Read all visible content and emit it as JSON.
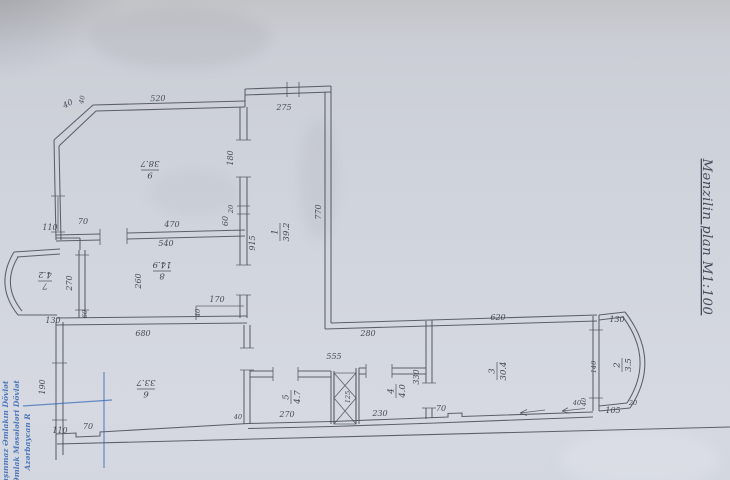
{
  "page": {
    "side_title": "Mənzilin plan M1:100",
    "stamp": {
      "color": "#3565b5",
      "lines": [
        "Daşınmaz Əmlakın Dövlət",
        "Əmlak Məsələləri Dövlət",
        "Azərbaycan R"
      ]
    }
  },
  "plan": {
    "rooms": [
      {
        "number": "1",
        "area": "39.2"
      },
      {
        "number": "2",
        "area": "3.5"
      },
      {
        "number": "3",
        "area": "30.4"
      },
      {
        "number": "4",
        "area": "4.0"
      },
      {
        "number": "5",
        "area": "4.7"
      },
      {
        "number": "6",
        "area": "33.7"
      },
      {
        "number": "7",
        "area": "4.2"
      },
      {
        "number": "8",
        "area": "14.9"
      },
      {
        "number": "9",
        "area": "38.7"
      }
    ],
    "dims": {
      "chamfer_40a": "40",
      "chamfer_40b": "40",
      "r9_top": "520",
      "corridor_top": "275",
      "corridor_right": "770",
      "corridor_len": "915",
      "door9_180": "180",
      "corridor_20": "20",
      "r9_110": "110",
      "r9_70": "70",
      "r9_bottom": "470",
      "junction_60": "60",
      "r8_top": "540",
      "r8_height": "260",
      "bow7_window": "270",
      "bow7_bottom": "130",
      "r8_step_170": "170",
      "r8_step_40": "40",
      "r6_60": "60",
      "r6_top": "680",
      "r6_window": "190",
      "r6_110": "110",
      "r6_70": "70",
      "r6_40": "40",
      "hall_555": "555",
      "hall_280": "280",
      "r5_bottom": "270",
      "shaft_125": "125",
      "r4_bottom": "230",
      "r4_wall": "330",
      "r3_top": "620",
      "r3_70": "70",
      "r3_40": "40",
      "bow2_top": "130",
      "bow2_window": "140",
      "bow2_105": "105",
      "bow2_20": "20",
      "bow2_40": "40"
    }
  }
}
